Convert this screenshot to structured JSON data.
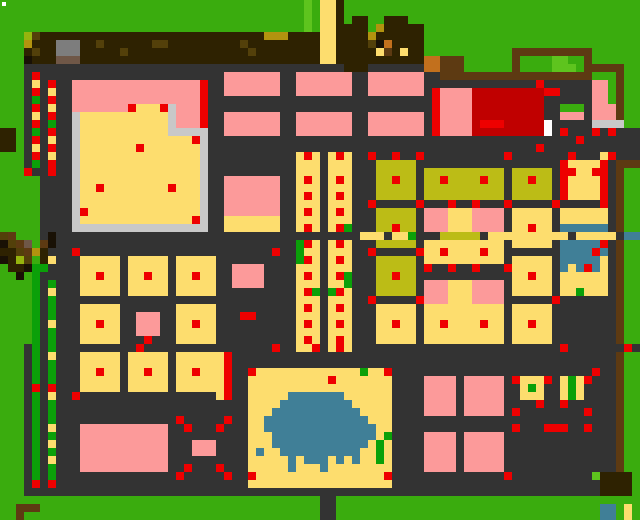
{
  "map": {
    "tile_size": 8,
    "cols": 80,
    "rows": 65,
    "palette": {
      ".": {
        "name": "grass",
        "color": "#3aac0e"
      },
      "H": {
        "name": "light-grass",
        "color": "#5ec41e"
      },
      "v": {
        "name": "yellow-green",
        "color": "#96b40e"
      },
      "#": {
        "name": "path-dark",
        "color": "#333333"
      },
      "b": {
        "name": "dark-brown",
        "color": "#2e2201"
      },
      "B": {
        "name": "brown-speckle",
        "color": "#53400a"
      },
      "t": {
        "name": "tan",
        "color": "#b2930f"
      },
      "F": {
        "name": "fence-brown",
        "color": "#5d3a12"
      },
      "o": {
        "name": "orange",
        "color": "#c2701d"
      },
      "k": {
        "name": "near-black",
        "color": "#191105"
      },
      "w": {
        "name": "gray-brown",
        "color": "#6f5747"
      },
      "a": {
        "name": "gray",
        "color": "#7d7d7d"
      },
      "l": {
        "name": "light-gray",
        "color": "#c8c8c8"
      },
      "P": {
        "name": "pink-building",
        "color": "#fc9a9a"
      },
      "Y": {
        "name": "yellow-building",
        "color": "#fddd6e"
      },
      "O": {
        "name": "olive-building",
        "color": "#bcbc16"
      },
      "R": {
        "name": "red-dot",
        "color": "#ee0000"
      },
      "C": {
        "name": "dark-red-building",
        "color": "#c00000"
      },
      "U": {
        "name": "water-blue",
        "color": "#407f97"
      },
      "T": {
        "name": "bright-green",
        "color": "#0ba009"
      },
      "W": {
        "name": "white",
        "color": "#ffffff"
      }
    },
    "grid": [
      "......................................H.YYb.....................................",
      "......................................H.YYb.....................................",
      "......................................H.YYb.bb..bbb.............................",
      "......................................H.YYbbbb.tbbbbb...........................",
      "...vBbbbbbbbbbbbbbbbbbbbbbbbbbbbbtttbbbbYYbbbbtbbbbbb...........................",
      "...tbbbaaabbBbbbbbbBBbbbbbbbbbBbbbbbbbbbYYbbbbBkobbbb...........................",
      "...bBbbaaabbbbbBbbbbbbbbbbbbbbbBbbbbbbbbYYbbbbbYFbYbb...........FFFFFFFFFF......",
      "...kbbbwwwbbbbbbbbbbbbbbbbbbbbbbbbbbbbbbYYbbbbbbbbbbbooFFF......F....HH..F......",
      "...########################################bbb#######ooFFF......F....HHH.FFFFF..",
      "...#R#######################PPPPPPP##PPPPPPP##PPPPPPP##FFFFFFFFFFFFFFFFFFF...F..",
      "...#Y#R##PPPPPPPPPPPPPPPPR##PPPPPPP##PPPPPPP##PPPPPPP##############R######PP.F..",
      "...#R#Y##PPPPPPPPPPPPPPPPR##PPPPPPP##PPPPPPP##PPPPPPP#RPPPPCCCCCCCCCRR####PP.F..",
      "...#T#R##PPPPPPPPPPPPPPPPR############################RPPPPCCCCCCCCC######PP.F..",
      "...#R#Y##PPPPPPPRYYYRlPPPR############################RPPPPCCCCCCCCC##...#PPPF..",
      "...#Y#R##lYYYYYYYYYYYlPPPR##PPPPPPP##PPPPPPP##PPPPPPP#RPPPPCCCCCCCCC##PPP#PPPF..",
      "...#R#T##lYYYYYYYYYYYlPPPR##PPPPPPP##PPPPPPP##PPPPPPP#RPPPPCRRRCCCCCW#####llll..",
      "bb.#T#R##lYYYYYYYYYYYlllll##PPPPPPP##PPPPPPP##PPPPPPP#RPPPPCCCCCCCCCW#R###R#R###",
      "bb.#R#Y##lYYYYYYYYYYYYYYRl##############################################R#######",
      "bb.#Y#R##lYYYYYYYRYYYYYYYl#########################################R############",
      "...#R#Y##lYYYYYYYYYYYYYYYl###########YRY#YRY##R##R##R##########R#######R###YR###",
      "...#T#R##lYYYYYYYYYYYYYYYl###########YYY#YYY###OOOOO##################RYYYYR#FFF",
      "...R##R##lYYYYYYYYYYYYYYYl###########YYY#YYY###OOOOO#OOOOOOOOOO#OOOOO#RRYYRR#F..",
      ".....####lYYYYYYYYYYYYYYYl##PPPPPPP##YRY#YRY###OOROO#OOROOOOROO#OOROO#RYYYYR#F..",
      ".....####lYYRYYYYYYYYRYYYl##PPPPPPP##YYY#YYY###OOOOO#OOOOOOOOOO#OOOOO#RYYYYR#F..",
      ".....####lYYYYYYYYYYYYYYYl##PPPPPPP##YRY#YRY###OOOOO#OOOOOOOOOO#OOOOO#RYYYYR#F..",
      ".....####lYYYYYYYYYYYYYYYl##PPPPPPP##YYY#YYY##R#####R###R##R###R#####R#####R#F..",
      ".....####lRYYYYYYYYYYYYYYl##PPPPPPP##YRY#YRY###OOOOO#PPPYYYPPPP#YYYYY#YYYYYY#F..",
      ".....####lYYYYYYYYYYYYYYRl##YYYYYYY##YYY#YYY###OOOOO#PPPYYYPPPP#YYYYY#YYYYYY#F..",
      ".....####lllllllllllllllll##YYYYYYY##YRY#YRT###OOROO#PPPYYYPPPP#YYRYY#UUUUUU#F..",
      "BF...#k######################################YYY#YYT###OOOOO#YYYYYYYYYY#YYYYY#UUUURU#F..",
      "kBFw.Fk##############################TRY#YRY###OOOOO#YYYYYYYYYY#YYYYY#UUUUUR#F..",
      "bbBFtb###R########################R##TYY#YYY##R#####RYYRYYYYRYY#######UUUURU#F..",
      "kbvB.bY###YYYYY#YYYYY#YYYYY##########TRY#YRY###OOOOO#YYYYYYYYYY#YYYYY#UUUUUY#F..",
      ".bbkTT####YYYYY#YYYYY#YYYYY##PPPP####YYY#YYY###OOOOO#R##R##R###RYYYYY#UYURUY#F..",
      "..k.T#####YYRYY#YYRYY#YYRYY##PPPP####YRY#YRT###OOROO############YYRYY#YYYYYY#F..",
      "....T#T###YYYYY#YYYYY#YYYYY##PPPP####YYY#YYT###OOOOO#PPPYYYPPPP#YYYYY#YYYYYY#F..",
      "....T#Y###YYYYY#YYYYY#YYYYY##########YRT#TRY###OOOOO#PPPYYYPPPP#YYYYY#YYTYYY#F..",
      "....T#T##############################YYY#YYY##R#####RPPPYYYPPPP######R#######F..",
      "....T#T###YYYYY#######YYYYY##########YRY#YRY###YYYYY#YYYYYYYYYY#YYYYY########F..",
      "....T#T###YYYYY##PPP##YYYYY###RR#####YYY#YYY###YYYYY#YYYYYYYYYY#YYYYY########F..",
      "....T#Y###YYRYY##PPP##YYRYY##########YRY#YRY###YYRYY#YYRYYYYRYY#YYRYY########F..",
      "....T#T###YYYYY##PPP##YYYYY##########YYY#YYY###YYYYY#YYYYYYYYYY#YYYYY########F..",
      "....T#T###YYYYY###R###YYYYY##########YRY#YRY###YYYYY#YYYYYYYYYY#YYYYY########F..",
      "...#T#T##########R################R##YYR#YRY##########################R#######R#####F..",
      "...#T#Y###YYYYY#YYYYY#YYYYYYR################################################F..",
      "...#T#T###YYYYY#YYYYY#YYYYYYR################################################F..",
      "...#T#T###YYRYY#YYRYY#YYRYYYR##RYYYYYYYYYYYYYTYYR#########################R##F..",
      "...#T#T###YYYYY#YYYYY#YYYYYYR##YYYYYYYYYYRYYYYYYY####PPPP#PPPPP#RYYYR#YTYR###F..",
      "...#R#R###YYYYY#YYYYY#YYYYYYR##YYYYYYYYYYYYYYYYYY####PPPP#PPPPP##YTY##YTY####F..",
      "...#T#Y##R#################YR##YYYYYUUUUUUUYYYYYY####PPPP#PPPPP##YYY##YTY####F..",
      "...#T#T########################YYYYUUUUUUUUUYYYYY####PPPP#PPPPP####R##R######F..",
      "...#T#T########################YYYUUUUUUUUUUUYYYY####PPPP#PPPPP#R########R###F..",
      "...#T#T###############R#####R##YYUUUUUUUUUUUUUYYY############################F..",
      "...#T#Y###PPPPPPPPPPP##R###R###YYUUUUUUUUUUUUUUYY###############R###RRR##R###F..",
      "...#T#T###PPPPPPPPPPP##########YYYUUUUUUUUUUUUUYT####PPPP#PPPPP##############F..",
      "...#T#Y###PPPPPPPPPPP###PPP####YYYUUUUUUUUUUUUYTY####PPPP#PPPPP##############F..",
      "...#T#T###PPPPPPPPPPP###PPP####YUYYUUUUUUUUUUYYTY####PPPP#PPPPP##############F..",
      "...#T#Y###PPPPPPPPPPP##########YYYYYUYUUUYUYUYYTY####PPPP#PPPPP##############F..",
      "...#T#T###PPPPPPPPPPP##R###R###YYYYYUYYYUYYYYYYYY####PPPP#PPPPP##############F..",
      "...#T#T###############R#####R##RYYYYYYYYYYYYYYYYR##############R##########Hbbbb.",
      "...#R#R########################YYYYYYYYYYYYYYYYYY##########################bbbb.",
      "...########################################################################bbbb.",
      "........................................##......................................",
      "..FFF...................................##.................................UU.Y.",
      "..F.....................................##.................................UU.Y."
    ],
    "overlays": [
      {
        "name": "white-marker",
        "x": 2,
        "y": 2,
        "w": 4,
        "h": 4,
        "color": "#ffffff"
      }
    ]
  }
}
